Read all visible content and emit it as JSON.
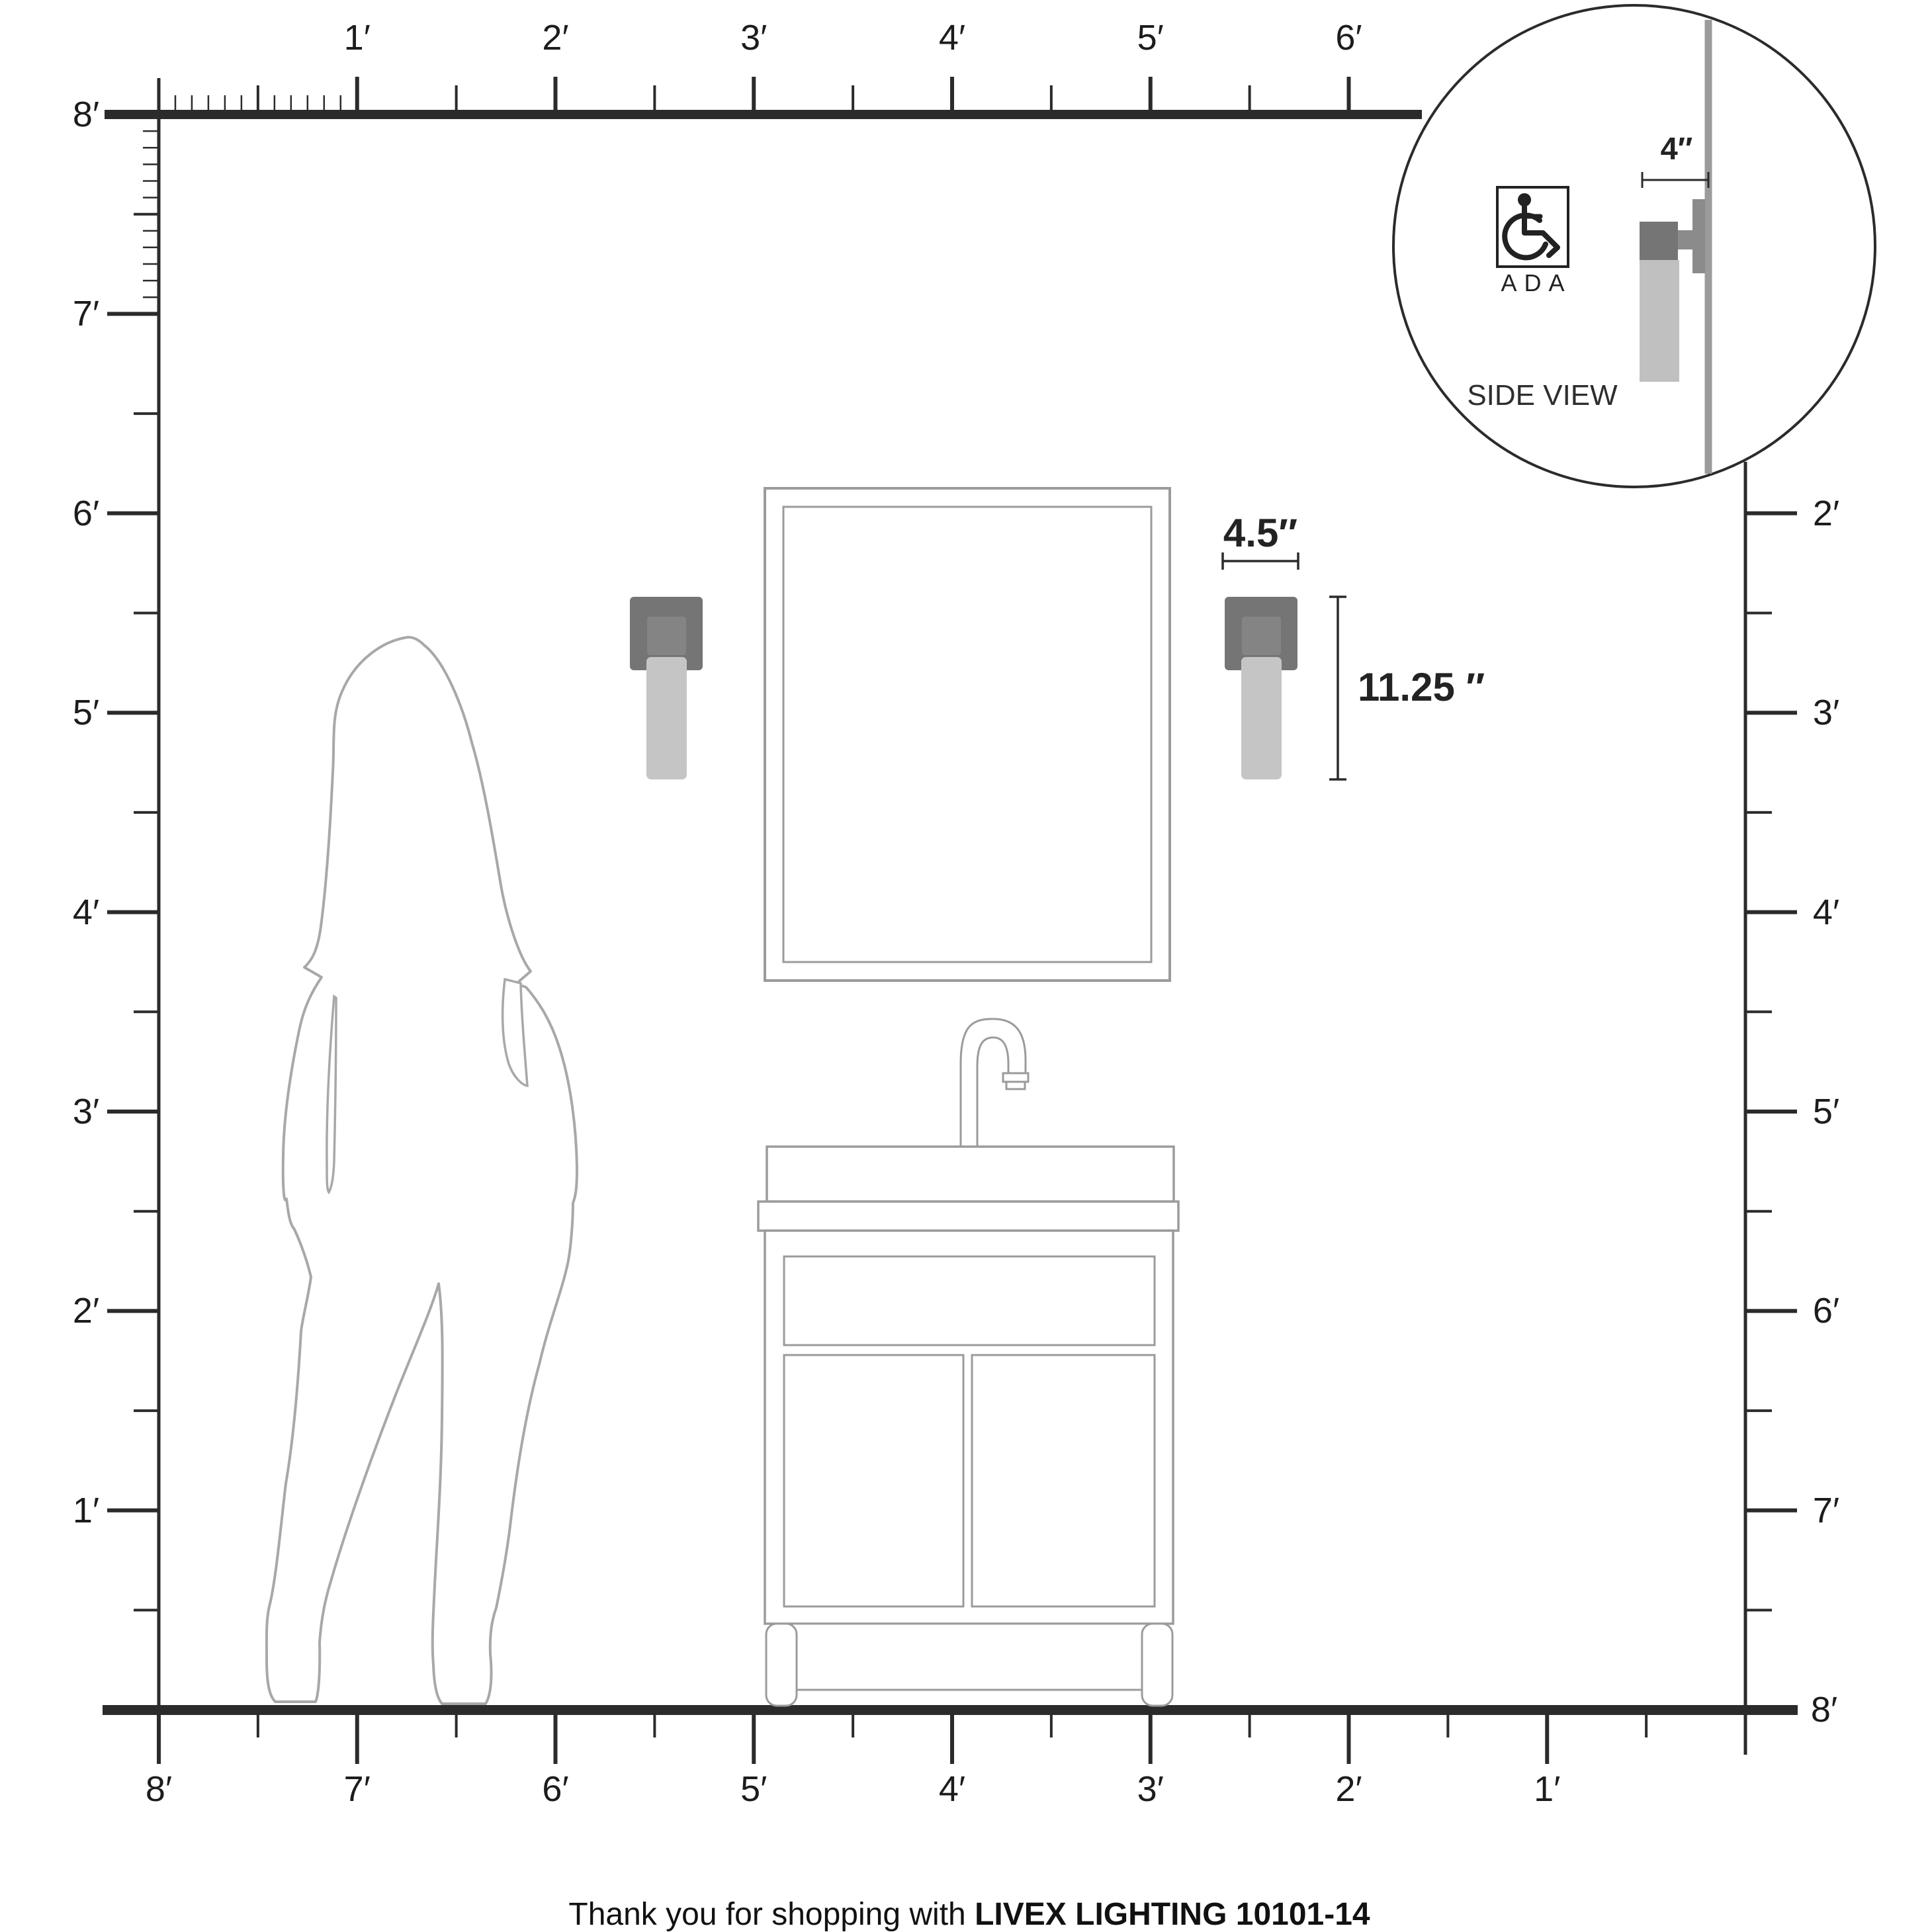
{
  "axes": {
    "top": {
      "labels": [
        "1′",
        "2′",
        "3′",
        "4′",
        "5′",
        "6′"
      ]
    },
    "left": {
      "labels": [
        "8′",
        "7′",
        "6′",
        "5′",
        "4′",
        "3′",
        "2′",
        "1′"
      ]
    },
    "right": {
      "labels": [
        "2′",
        "3′",
        "4′",
        "5′",
        "6′",
        "7′",
        "8′"
      ]
    },
    "bottom": {
      "labels": [
        "8′",
        "7′",
        "6′",
        "5′",
        "4′",
        "3′",
        "2′",
        "1′"
      ]
    }
  },
  "dimensions": {
    "fixture_width": "4.5″",
    "fixture_height": "11.25 ″",
    "wall_depth": "4″"
  },
  "inset": {
    "ada_label": "ADA",
    "side_view_label": "SIDE VIEW"
  },
  "footer": {
    "prefix": "Thank you for shopping with",
    "brand": "LIVEX LIGHTING 10101-14"
  },
  "icons": {
    "ada_symbol": "wheelchair-icon"
  },
  "colors": {
    "ink": "#2b2b2b",
    "line_gray": "#9b9b9b",
    "sil_gray": "#a8a8a8",
    "backplate": "#757575",
    "plate_inner": "#848484",
    "glass": "#c5c5c5",
    "side_mount": "#8b8b8b",
    "side_body": "#757575",
    "side_glass": "#c0c0c0",
    "wall_gray": "#9b9b9b"
  }
}
